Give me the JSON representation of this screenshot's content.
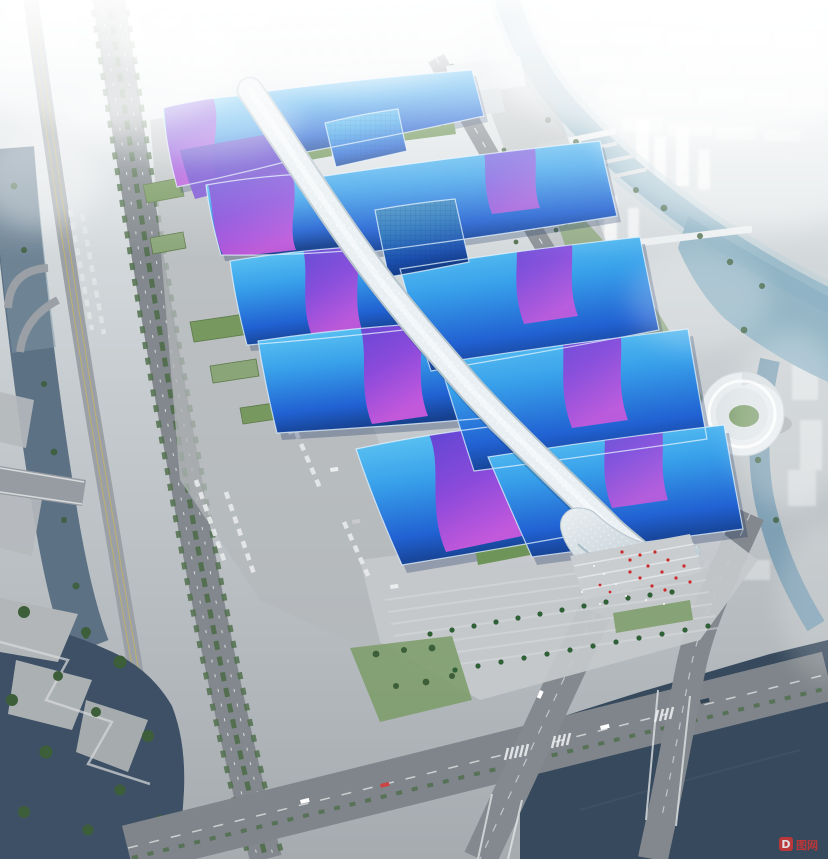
{
  "scene": {
    "type": "aerial-architectural-rendering",
    "subject": "exhibition-convention-center-complex",
    "features": [
      "central-spine-canopy",
      "blue-wave-roof-halls",
      "purple-ribbon-bands",
      "south-entrance-plaza",
      "riverside-park",
      "city-in-fog",
      "canals",
      "elevated-expressway"
    ],
    "left_hall_count": 5,
    "right_hall_count": 5,
    "annex_hall_count": 2
  },
  "watermark": {
    "logo_letter": "D",
    "text": "图网"
  },
  "colors": {
    "sky_top": "#eef2f4",
    "sky_mid": "#c6cccf",
    "ground": "#a6abb0",
    "apron": "#b4b8bb",
    "plaza": "#c5c9cc",
    "road": "#82888d",
    "road_dark": "#7f858a",
    "viaduct": "#9aa0a5",
    "lane_yellow": "#c9b55f",
    "water_west": "#5c7183",
    "water_sw": "#3e5065",
    "water_se": "#37495c",
    "river_ne": "#9cbccb",
    "pool_ne": "#8fb2c4",
    "canal": "#7fa0b4",
    "hall_light": "#66cdf4",
    "hall_mid": "#38a0ea",
    "hall_deep": "#2161d2",
    "hall_navy": "#16418f",
    "band_violet": "#5b3fd0",
    "band_purple": "#8f46da",
    "band_magenta": "#cb59dd",
    "wing_indigo": "#4a3fc4",
    "wing_violet": "#7a4ad4",
    "spine_white": "#e9eff2",
    "spine_shade": "#b6c4cc",
    "green_roof": "#6f9459",
    "tree": "#3c5e38",
    "lawn": "#7e9d6d",
    "palm": "#2f6036",
    "city_white": "#ffffff",
    "red_accent": "#cc2a2a",
    "watermark_red": "#d23434"
  }
}
